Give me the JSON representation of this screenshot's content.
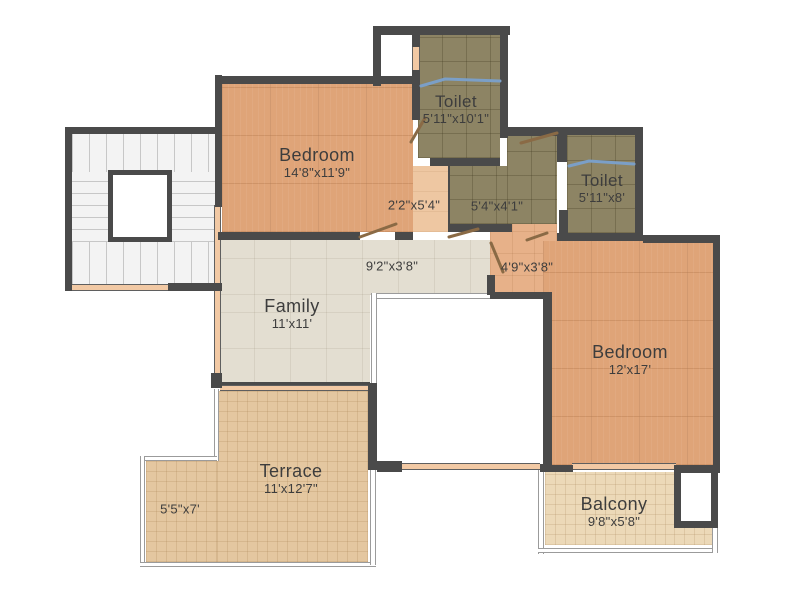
{
  "rooms": {
    "bedroom_top": {
      "name": "Bedroom",
      "dims": "14'8\"x11'9\""
    },
    "toilet_top": {
      "name": "Toilet",
      "dims": "5'11\"x10'1\""
    },
    "toilet_right": {
      "name": "Toilet",
      "dims": "5'11\"x8'"
    },
    "family": {
      "name": "Family",
      "dims": "11'x11'"
    },
    "bedroom_right": {
      "name": "Bedroom",
      "dims": "12'x17'"
    },
    "terrace": {
      "name": "Terrace",
      "dims": "11'x12'7\""
    },
    "balcony": {
      "name": "Balcony",
      "dims": "9'8\"x5'8\""
    }
  },
  "passages": {
    "beside_bedroom_top": {
      "dims": "2'2\"x5'4\""
    },
    "toilet_lobby": {
      "dims": "5'4\"x4'1\""
    },
    "hall": {
      "dims": "9'2\"x3'8\""
    },
    "bedroom_lobby": {
      "dims": "4'9\"x3'8\""
    },
    "terrace_side": {
      "dims": "5'5\"x7'"
    }
  },
  "colors": {
    "wall": "#4a4a4a",
    "bedroom_floor": "#dfa478",
    "toilet_floor": "#8d8464",
    "family_floor": "#e3ded1",
    "terrace_floor": "#e4c7a0",
    "balcony_floor": "#ecd9b8",
    "window_band": "#f2c9a4",
    "glass_partition": "#7b9fc7",
    "door_swing": "#8a6a45",
    "label_text": "#3d3d3d"
  }
}
